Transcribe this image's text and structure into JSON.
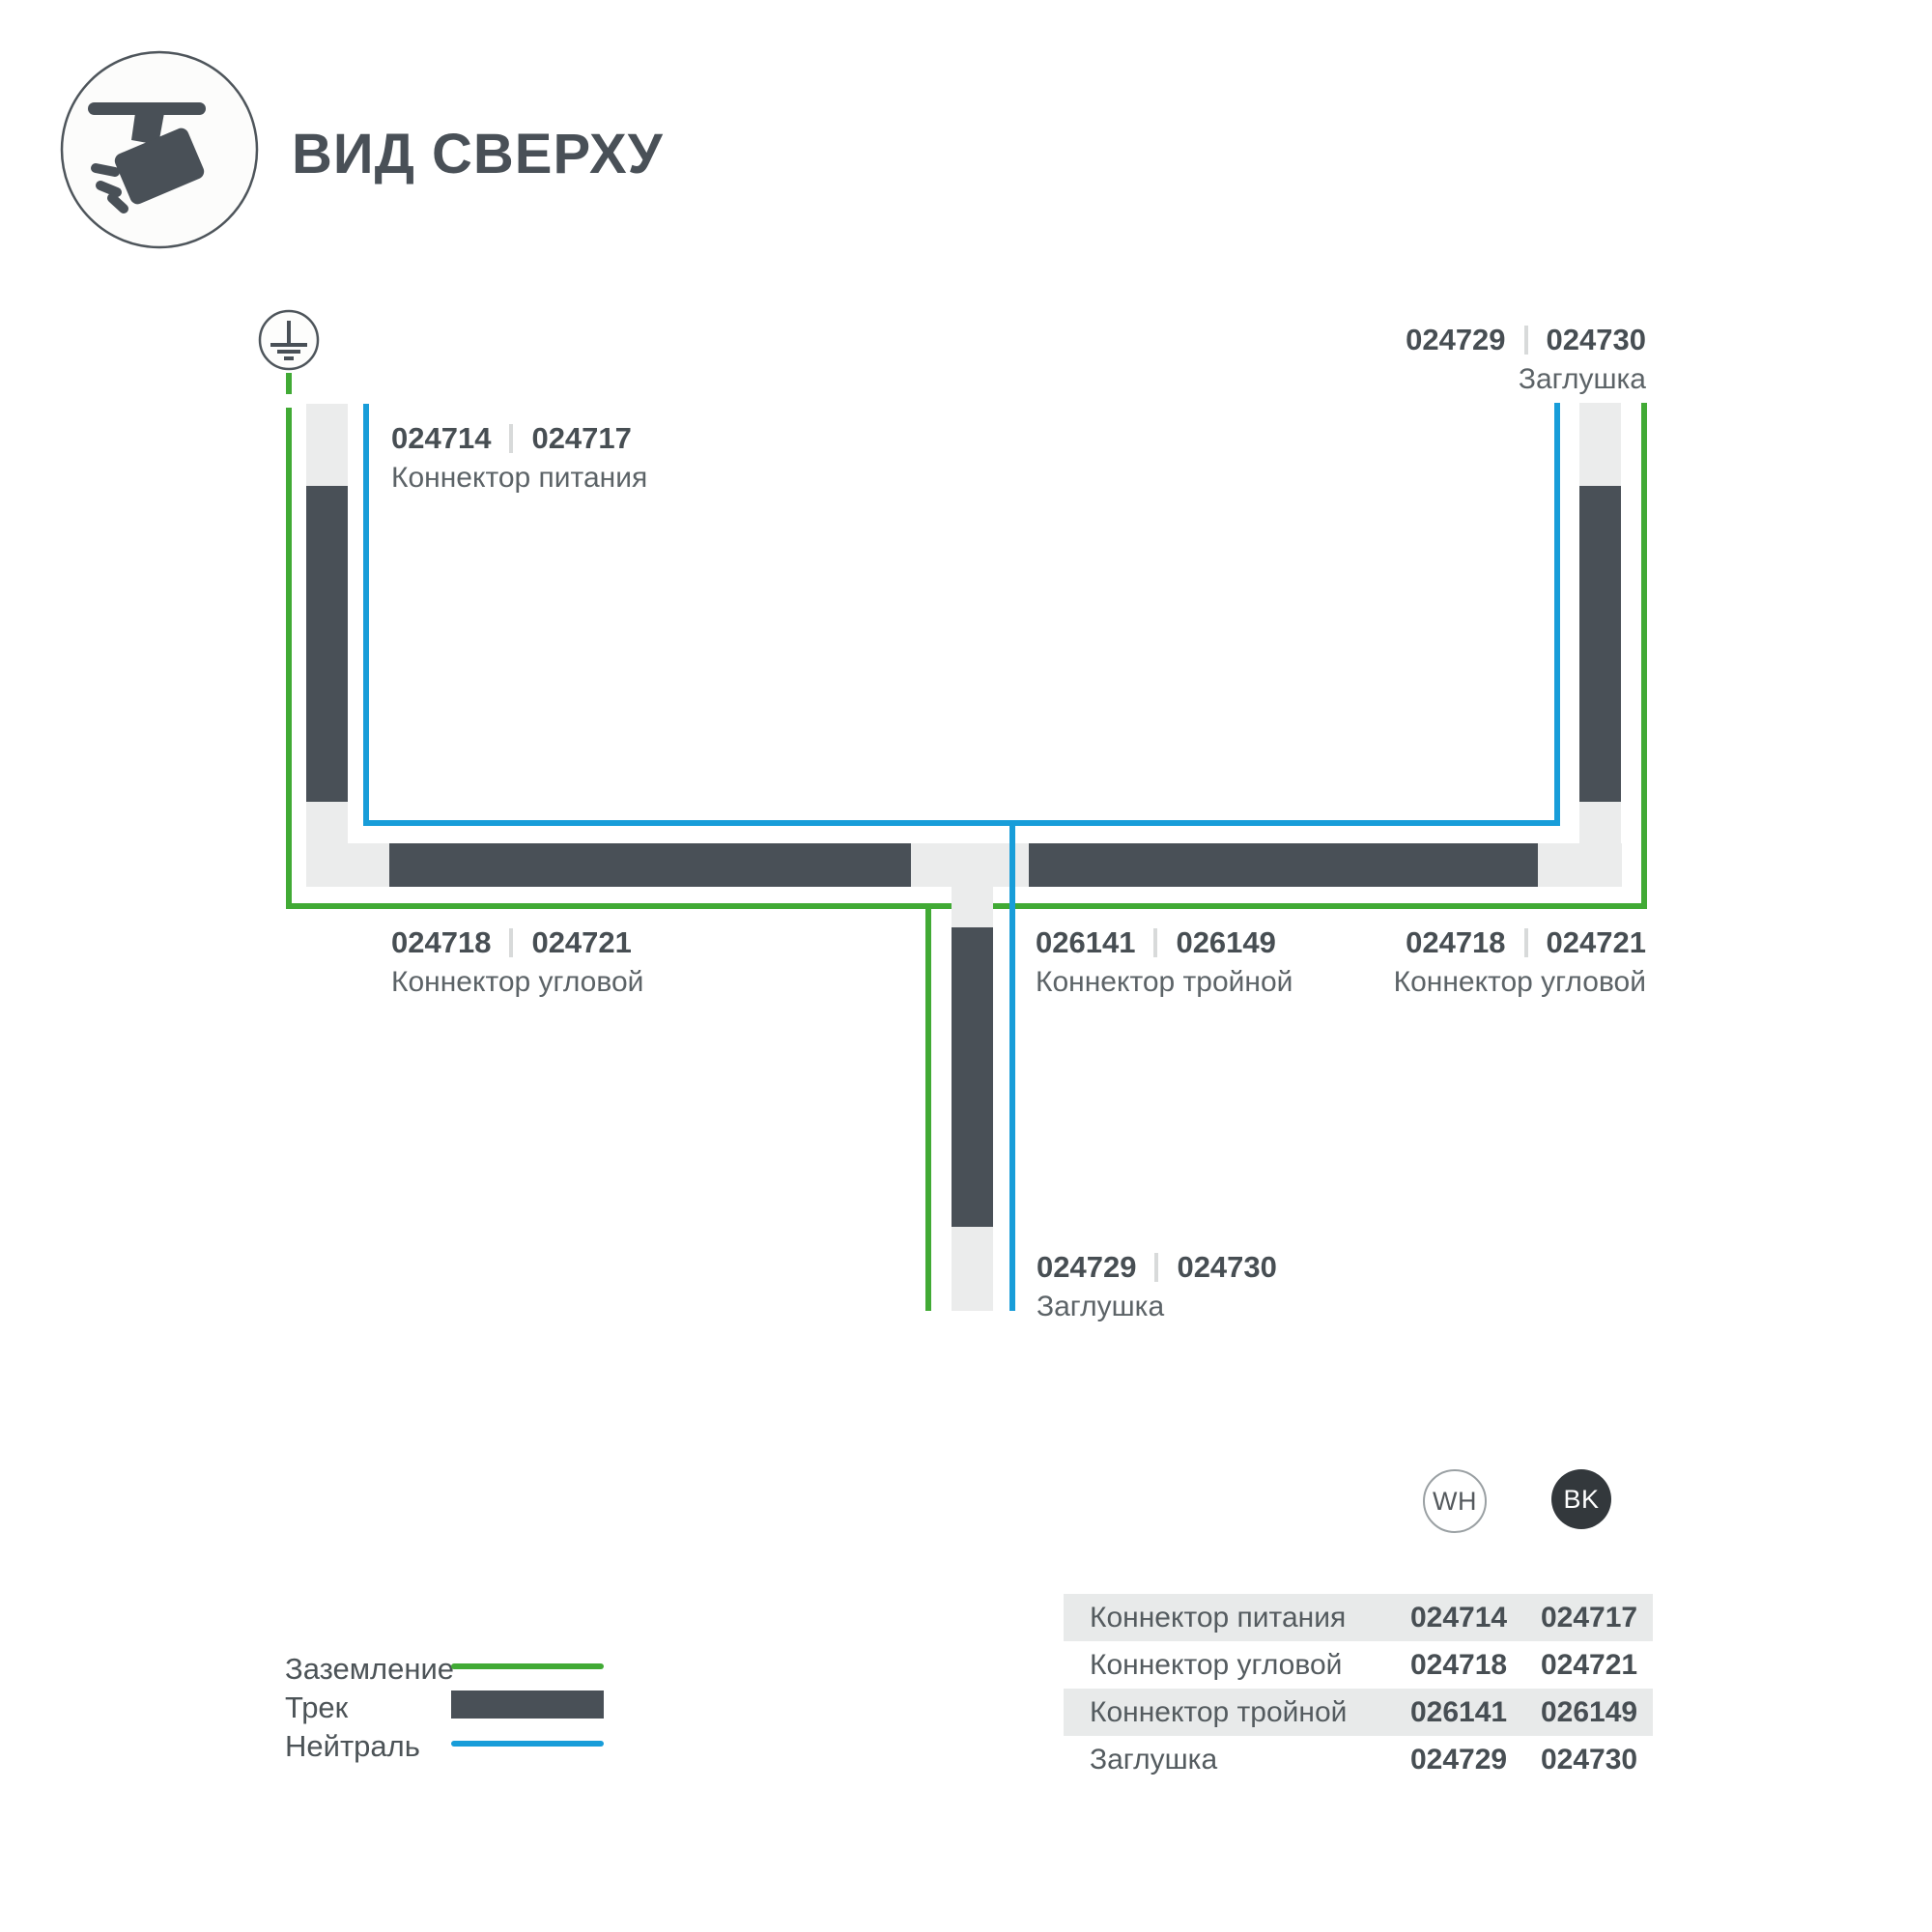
{
  "header": {
    "title": "ВИД СВЕРХУ"
  },
  "diagram": {
    "labels": {
      "power": {
        "wh": "024714",
        "bk": "024717",
        "name": "Коннектор питания"
      },
      "endcap_top": {
        "wh": "024729",
        "bk": "024730",
        "name": "Заглушка"
      },
      "corner_left": {
        "wh": "024718",
        "bk": "024721",
        "name": "Коннектор угловой"
      },
      "tee": {
        "wh": "026141",
        "bk": "026149",
        "name": "Коннектор тройной"
      },
      "corner_right": {
        "wh": "024718",
        "bk": "024721",
        "name": "Коннектор угловой"
      },
      "endcap_bottom": {
        "wh": "024729",
        "bk": "024730",
        "name": "Заглушка"
      }
    }
  },
  "variants": {
    "wh": "WH",
    "bk": "BK"
  },
  "table": {
    "rows": [
      {
        "name": "Коннектор питания",
        "wh": "024714",
        "bk": "024717"
      },
      {
        "name": "Коннектор угловой",
        "wh": "024718",
        "bk": "024721"
      },
      {
        "name": "Коннектор тройной",
        "wh": "026141",
        "bk": "026149"
      },
      {
        "name": "Заглушка",
        "wh": "024729",
        "bk": "024730"
      }
    ]
  },
  "legend": {
    "items": [
      {
        "label": "Заземление",
        "swatch": "green-line"
      },
      {
        "label": "Трек",
        "swatch": "dark-bar"
      },
      {
        "label": "Нейтраль",
        "swatch": "blue-line"
      }
    ]
  },
  "colors": {
    "track_dark": "#495057",
    "track_light": "#ebecec",
    "ground_green": "#41aa35",
    "neutral_blue": "#189dd9",
    "number_text": "#474e53",
    "name_text": "#5c6367",
    "table_row_bg": "#e8eaea"
  }
}
